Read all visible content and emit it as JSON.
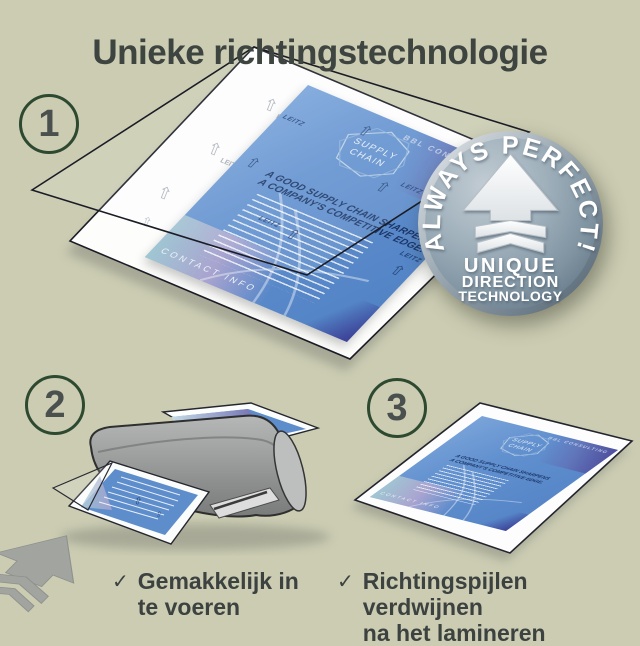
{
  "title": "Unieke richtingstechnologie",
  "steps": [
    {
      "number": "1"
    },
    {
      "number": "2"
    },
    {
      "number": "3"
    }
  ],
  "badge": {
    "arc_text": "ALWAYS PERFECT!",
    "line1": "UNIQUE",
    "line2": "DIRECTION",
    "line3": "TECHNOLOGY"
  },
  "document": {
    "brand": "BBL CONSULTING",
    "logo_top": "SUPPLY",
    "logo_bottom": "CHAIN",
    "headline1": "A GOOD SUPPLY CHAIN SHARPENS",
    "headline2": "A COMPANY'S COMPETITIVE EDGE.",
    "footer": "CONTACT INFO",
    "watermark": "LEITZ"
  },
  "checklist": [
    {
      "check": "✓",
      "line1": "Gemakkelijk in",
      "line2": "te voeren"
    },
    {
      "check": "✓",
      "line1": "Richtingspijlen verdwijnen",
      "line2": "na het lamineren"
    }
  ],
  "icons": {
    "watermark_arrow": "⇧",
    "badge_arrow": "up-arrow-with-chevrons",
    "checkmark": "✓"
  },
  "colors": {
    "background": "#cbccb2",
    "title_text": "#3e4440",
    "step_ring": "#2d4a30",
    "step_number": "#4a504e",
    "doc_blue": "#5d8ccc",
    "doc_navy": "#1a3566",
    "badge_face": "#8da0ad",
    "badge_text": "#ffffff",
    "machine_gray": "#9b9d9c"
  }
}
